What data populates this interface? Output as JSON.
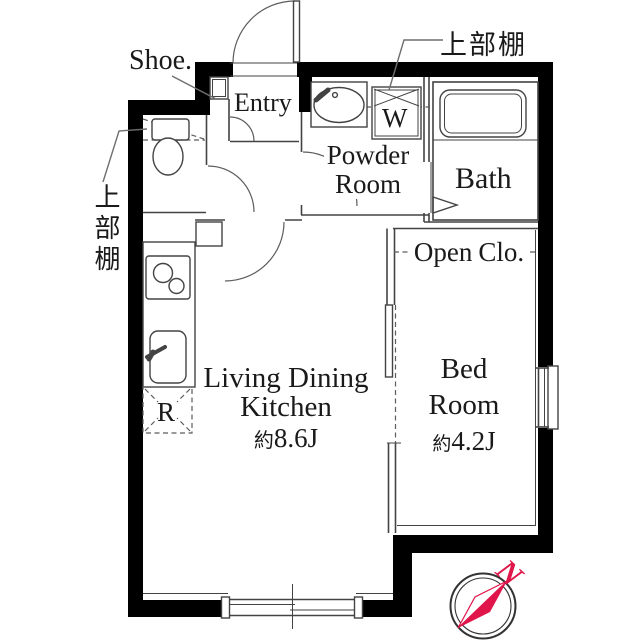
{
  "floorplan": {
    "rooms": {
      "ldk": {
        "name_line1": "Living Dining",
        "name_line2": "Kitchen",
        "area_prefix": "約",
        "area": "8.6J"
      },
      "bedroom": {
        "name_line1": "Bed",
        "name_line2": "Room",
        "area_prefix": "約",
        "area": "4.2J"
      },
      "bath": {
        "name": "Bath"
      },
      "powder_room": {
        "name_line1": "Powder",
        "name_line2": "Room"
      },
      "entry": {
        "name": "Entry"
      },
      "open_closet": {
        "word1": "Open",
        "word2": "Clo."
      }
    },
    "annotations": {
      "shoe_cabinet": "Shoe.",
      "upper_shelf_top": "上部棚",
      "upper_shelf_left": "上部棚",
      "washer_space": "W",
      "refrigerator_space": "R"
    },
    "compass": {
      "north": "N"
    },
    "colors": {
      "wall": "#000000",
      "line": "#434343",
      "compass_red": "#e0164a"
    }
  }
}
